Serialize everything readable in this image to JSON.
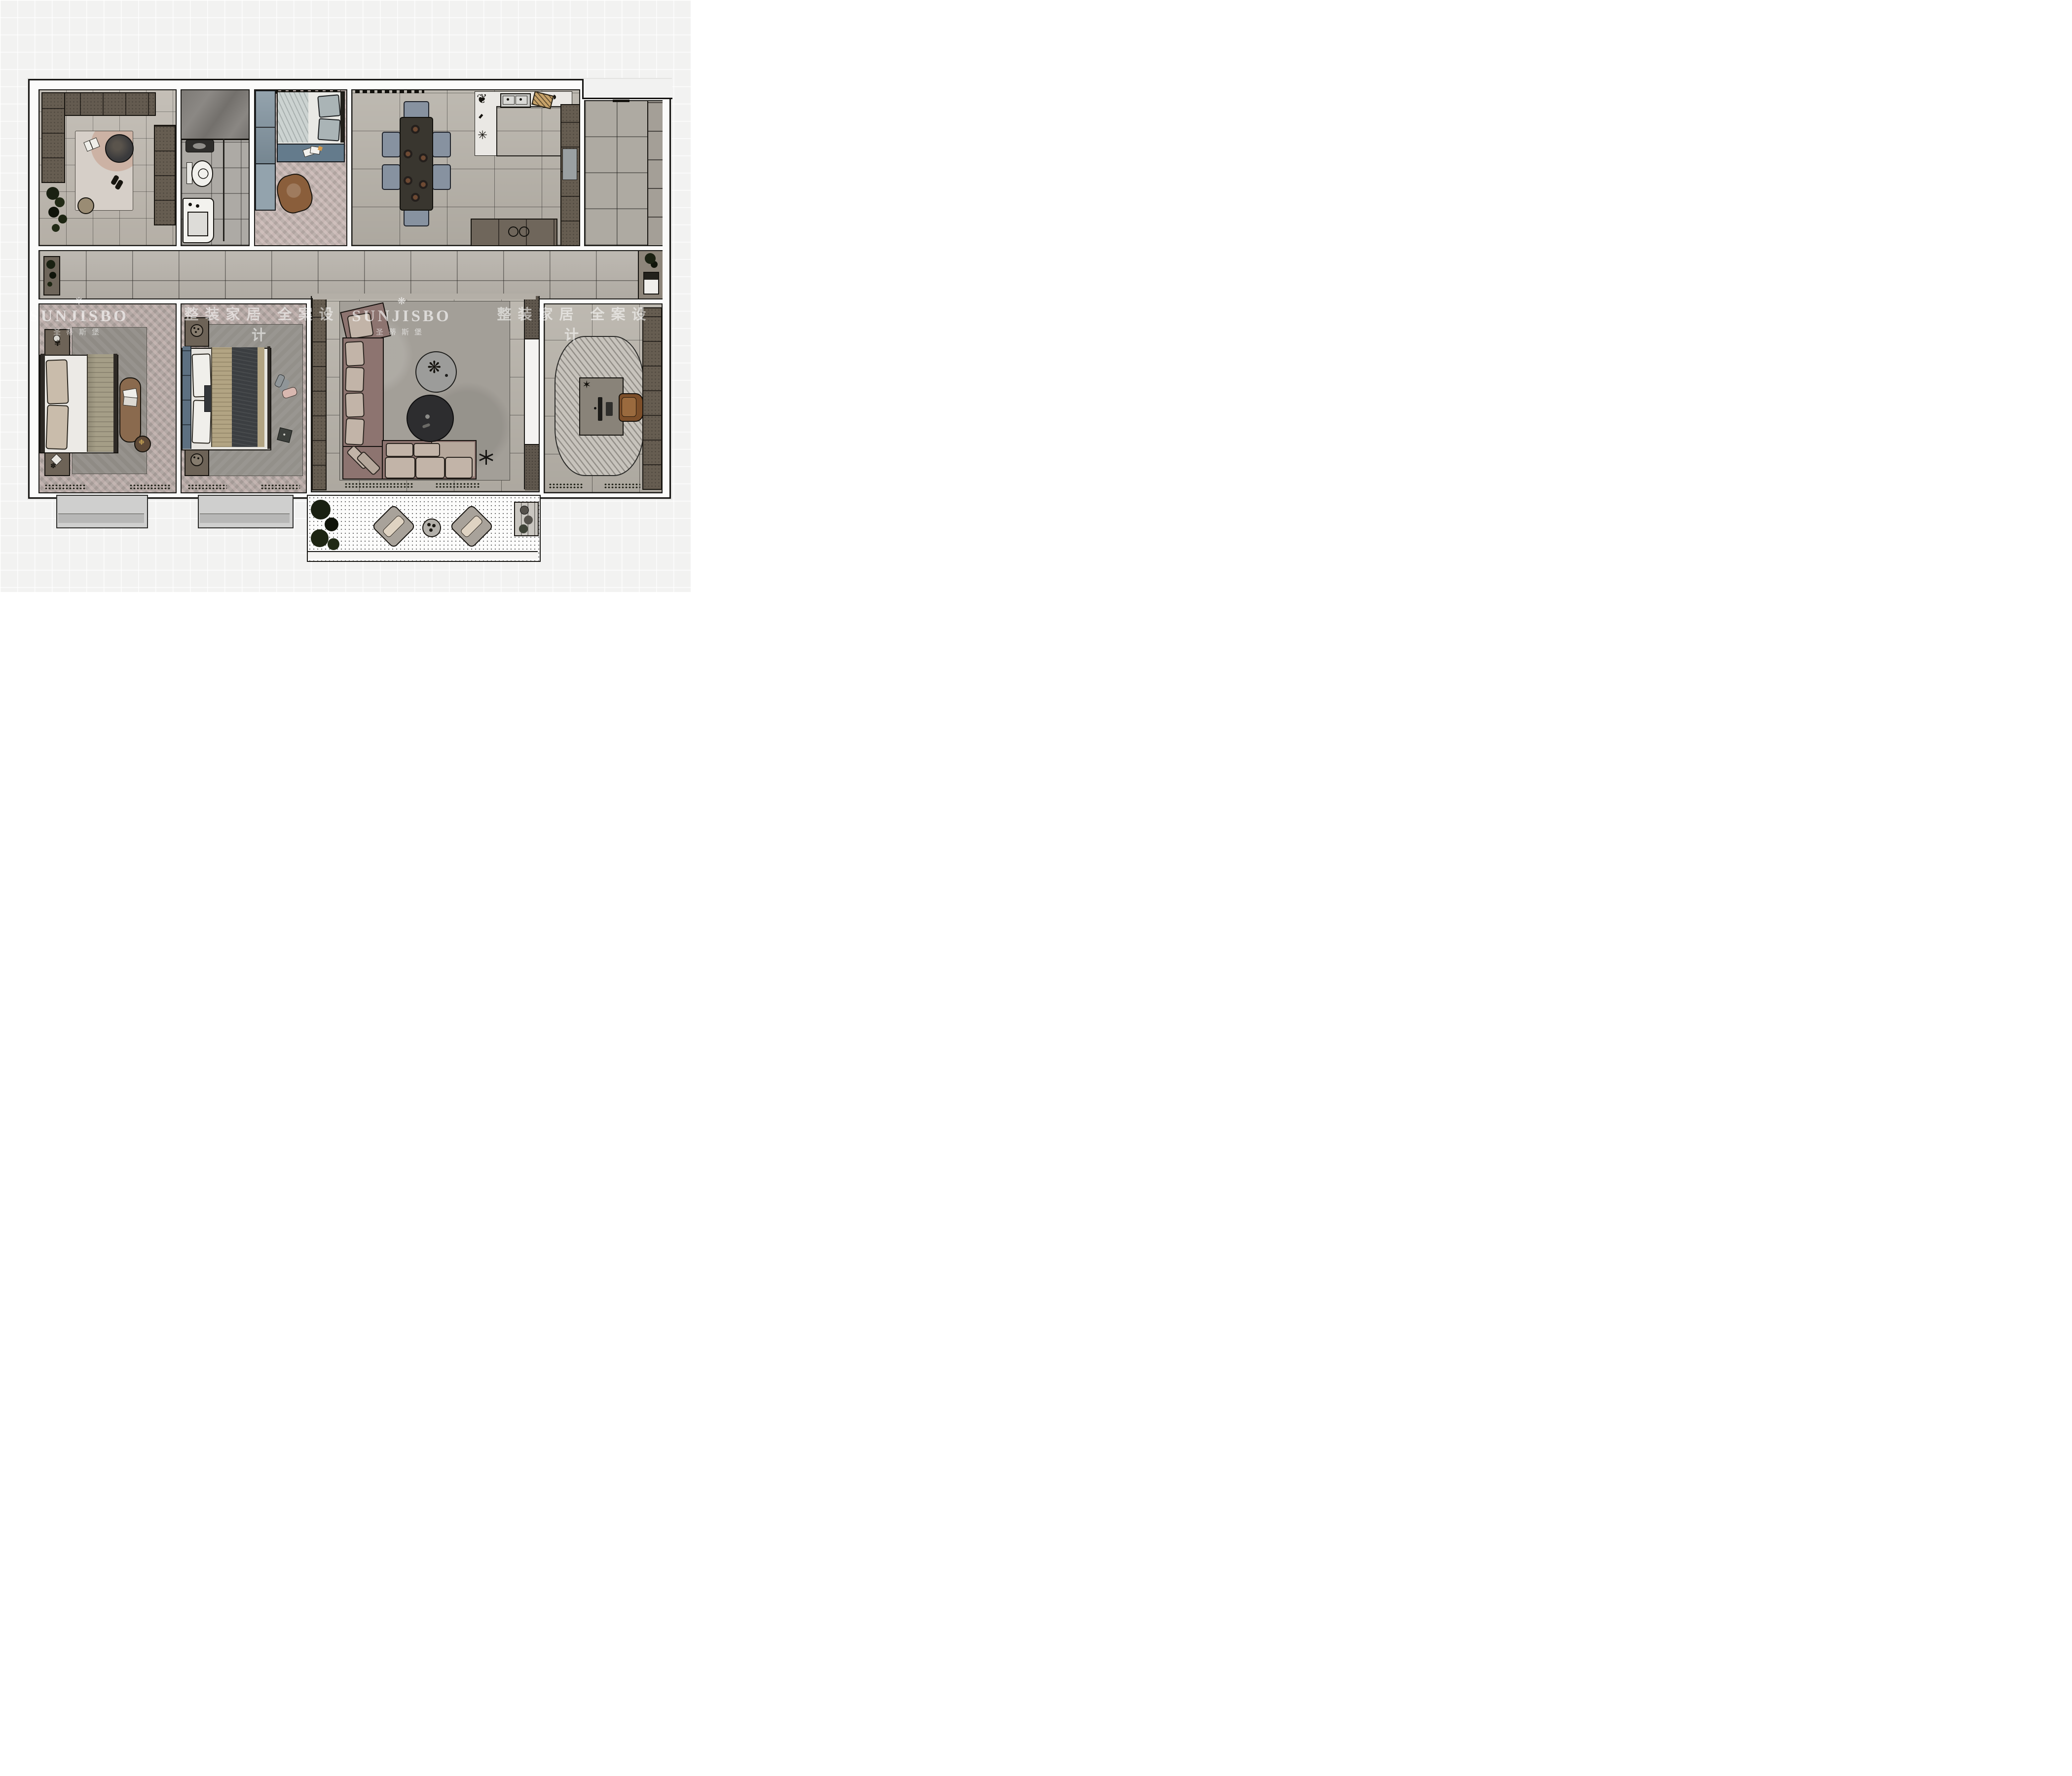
{
  "watermark": {
    "color": "rgba(255,255,255,0.62)",
    "items": [
      {
        "kind": "brand",
        "icon": "❋",
        "text": "SUNJISBO",
        "subtext": "圣蒂斯堡"
      },
      {
        "kind": "tagline",
        "text": "整装家居 全案设计"
      },
      {
        "kind": "brand",
        "icon": "❋",
        "text": "SUNJISBO",
        "subtext": "圣蒂斯堡"
      },
      {
        "kind": "tagline",
        "text": "整装家居 全案设计"
      }
    ]
  },
  "palette": {
    "page_background": "#f2f2f1",
    "wall": "#fbfbfa",
    "wall_line": "#1b1a17",
    "tile_floor": "#b6b1a8",
    "herringbone_floor": "#b2a8a4",
    "dark_cabinet": "#645b50",
    "blue_cabinet": "#7f919d",
    "bed_bench_blue": "#647b8c",
    "marble_shower": "#7a7773",
    "kitchen_counter": "#eae8e4",
    "dining_table": "#39362f",
    "dining_chair": "#8792a0",
    "sofa_base": "#8d7470",
    "sofa_cushion": "#c2b4a8",
    "rug_gray": "#8f8b85",
    "study_rug": "#c7c3bc",
    "desk": "#898379",
    "office_chair": "#7d4f2a",
    "bed_blanket_tan": "#a59e87",
    "bed_blanket_charcoal": "#3b3e41",
    "headboard_slate": "#5d7081",
    "plant": "#1a2112"
  }
}
